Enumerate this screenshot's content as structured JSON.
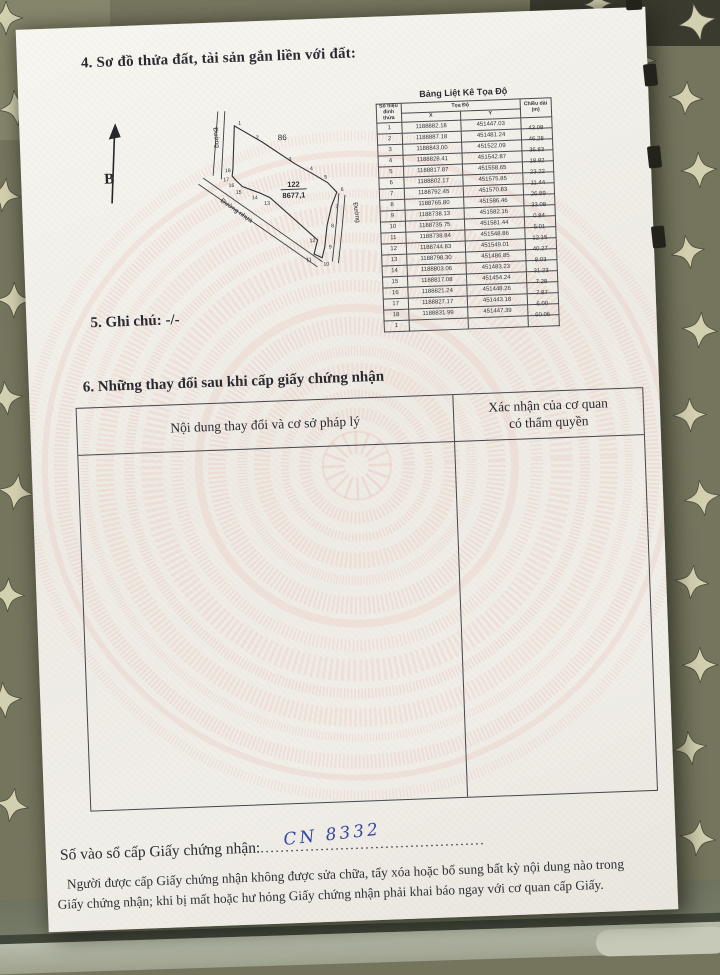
{
  "document": {
    "section4": {
      "heading": "4. Sơ đồ thửa đất, tài sản gắn liền với đất:"
    },
    "diagram": {
      "north_label": "B",
      "road_left_label": "Đường",
      "road_right_label": "Đường",
      "road_diagonal_label": "Đường nhựa",
      "adjacent_parcel_label": "86",
      "parcel_number": "122",
      "parcel_area": "8677,1",
      "vertices": [
        {
          "n": "1",
          "px": 145,
          "py": 9,
          "lx": 149,
          "ly": 8
        },
        {
          "n": "2",
          "px": 172,
          "py": 26,
          "lx": 166,
          "ly": 23
        },
        {
          "n": "3",
          "px": 204,
          "py": 49,
          "lx": 198,
          "ly": 46
        },
        {
          "n": "4",
          "px": 222,
          "py": 60,
          "lx": 219,
          "ly": 56
        },
        {
          "n": "5",
          "px": 236,
          "py": 69,
          "lx": 233,
          "ly": 65
        },
        {
          "n": "6",
          "px": 245,
          "py": 79,
          "lx": 249,
          "ly": 78
        },
        {
          "n": "7",
          "px": 239,
          "py": 93,
          "lx": 243,
          "ly": 95
        },
        {
          "n": "8",
          "px": 234,
          "py": 112,
          "lx": 238,
          "ly": 114
        },
        {
          "n": "9",
          "px": 231,
          "py": 133,
          "lx": 235,
          "ly": 135
        },
        {
          "n": "10",
          "px": 228,
          "py": 144,
          "lx": 229,
          "ly": 152
        },
        {
          "n": "11",
          "px": 220,
          "py": 140,
          "lx": 212,
          "ly": 147
        },
        {
          "n": "12",
          "px": 224,
          "py": 126,
          "lx": 216,
          "ly": 128
        },
        {
          "n": "13",
          "px": 178,
          "py": 82,
          "lx": 172,
          "ly": 89
        },
        {
          "n": "14",
          "px": 168,
          "py": 77,
          "lx": 160,
          "ly": 83
        },
        {
          "n": "15",
          "px": 151,
          "py": 70,
          "lx": 144,
          "ly": 77
        },
        {
          "n": "16",
          "px": 145,
          "py": 64,
          "lx": 137,
          "ly": 70
        },
        {
          "n": "17",
          "px": 141,
          "py": 59,
          "lx": 132,
          "ly": 64
        },
        {
          "n": "18",
          "px": 142,
          "py": 52,
          "lx": 134,
          "ly": 55
        }
      ]
    },
    "coord_table": {
      "title": "Bảng Liệt Kê Tọa Độ",
      "col_vertex": "Số hiệu đỉnh thửa",
      "col_coords": "Tọa Độ",
      "col_x": "X",
      "col_y": "Y",
      "col_length": "Chiều dài (m)",
      "rows": [
        {
          "n": "1",
          "x": "1188882.18",
          "y": "451447.03",
          "len": ""
        },
        {
          "n": "2",
          "x": "1188887.18",
          "y": "451481.24",
          "len": "43.08"
        },
        {
          "n": "3",
          "x": "1188843.00",
          "y": "451522.09",
          "len": "46.28"
        },
        {
          "n": "4",
          "x": "1188828.41",
          "y": "451542.87",
          "len": "36.83"
        },
        {
          "n": "5",
          "x": "1188817.87",
          "y": "451558.65",
          "len": "18.82"
        },
        {
          "n": "6",
          "x": "1188802.17",
          "y": "451575.85",
          "len": "23.22"
        },
        {
          "n": "7",
          "x": "1188792.45",
          "y": "451570.83",
          "len": "11.44"
        },
        {
          "n": "8",
          "x": "1188765.80",
          "y": "451586.46",
          "len": "26.89"
        },
        {
          "n": "9",
          "x": "1188738.13",
          "y": "451582.16",
          "len": "33.08"
        },
        {
          "n": "10",
          "x": "1188735.75",
          "y": "451581.44",
          "len": "0.84"
        },
        {
          "n": "11",
          "x": "1188738.84",
          "y": "451548.86",
          "len": "5.01"
        },
        {
          "n": "12",
          "x": "1188744.83",
          "y": "451549.01",
          "len": "12.15"
        },
        {
          "n": "13",
          "x": "1188798.30",
          "y": "451486.85",
          "len": "40.27"
        },
        {
          "n": "14",
          "x": "1188803.06",
          "y": "451483.23",
          "len": "8.03"
        },
        {
          "n": "15",
          "x": "1188817.08",
          "y": "451454.24",
          "len": "31.23"
        },
        {
          "n": "16",
          "x": "1188821.24",
          "y": "451448.26",
          "len": "7.28"
        },
        {
          "n": "17",
          "x": "1188827.17",
          "y": "451443.18",
          "len": "7.87"
        },
        {
          "n": "18",
          "x": "1188831.99",
          "y": "451447.39",
          "len": "6.00"
        },
        {
          "n": "1",
          "x": "",
          "y": "",
          "len": "60.06"
        }
      ]
    },
    "section5": {
      "text": "5. Ghi chú: -/-"
    },
    "section6": {
      "heading": "6. Những thay đổi sau khi cấp giấy chứng nhận",
      "table": {
        "col_change": "Nội dung thay đổi và cơ sở pháp lý",
        "col_confirm_line1": "Xác nhận của cơ quan",
        "col_confirm_line2": "có thẩm quyền"
      }
    },
    "footer": {
      "serial_label": "Số vào sổ cấp Giấy chứng nhận:",
      "serial_dots": ".............................................",
      "serial_value": "CN 8332",
      "note_line1": "Người được cấp Giấy chứng nhận không được sửa chữa, tẩy xóa hoặc bổ sung bất kỳ nội dung nào trong",
      "note_line2": "Giấy chứng nhận; khi bị mất hoặc hư hỏng Giấy chứng nhận phải khai báo ngay với cơ quan cấp Giấy."
    }
  }
}
